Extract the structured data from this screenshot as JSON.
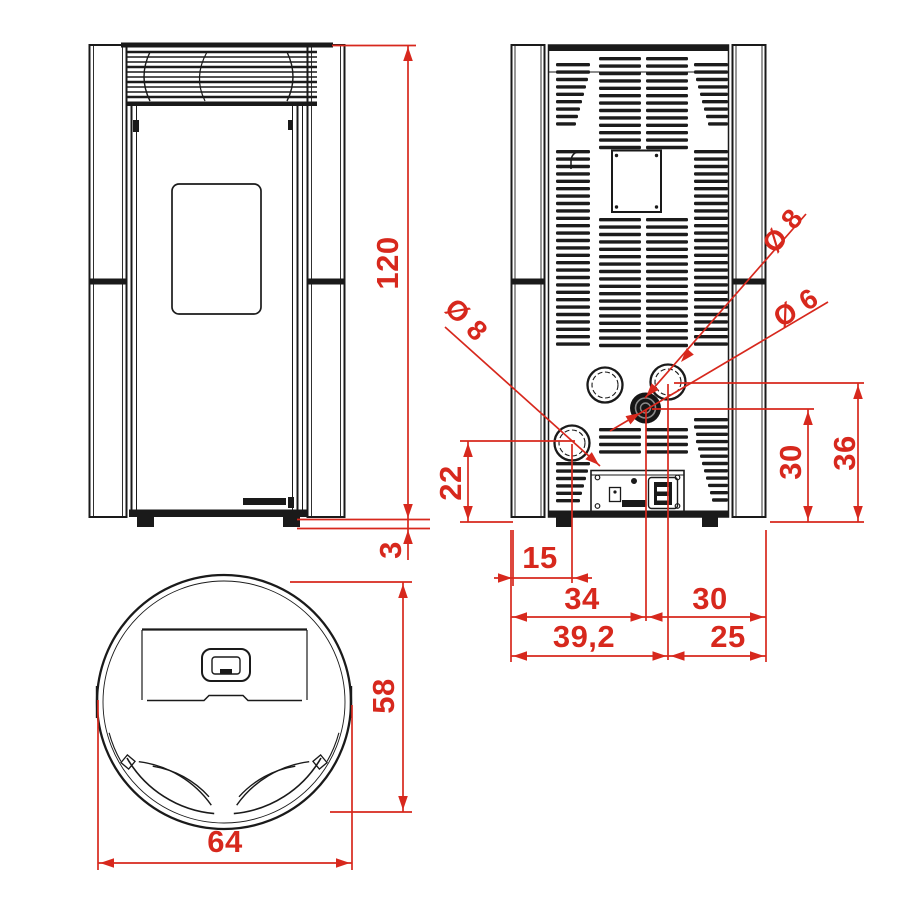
{
  "diagram": {
    "type": "pellet-stove dimensional drawing",
    "views": {
      "front": "front view",
      "rear": "rear view",
      "top": "top view"
    },
    "colors": {
      "dimension_red": "#d7281d",
      "line_black": "#1a1a1a"
    },
    "labels": {
      "height": "120",
      "base": "3",
      "depth": "58",
      "width": "64",
      "off15": "15",
      "w34": "34",
      "w30": "30",
      "w392": "39,2",
      "w25": "25",
      "h22": "22",
      "h30": "30",
      "h36": "36",
      "dia8_left": "Ø 8",
      "dia8_top": "Ø 8",
      "dia6": "Ø 6"
    }
  }
}
